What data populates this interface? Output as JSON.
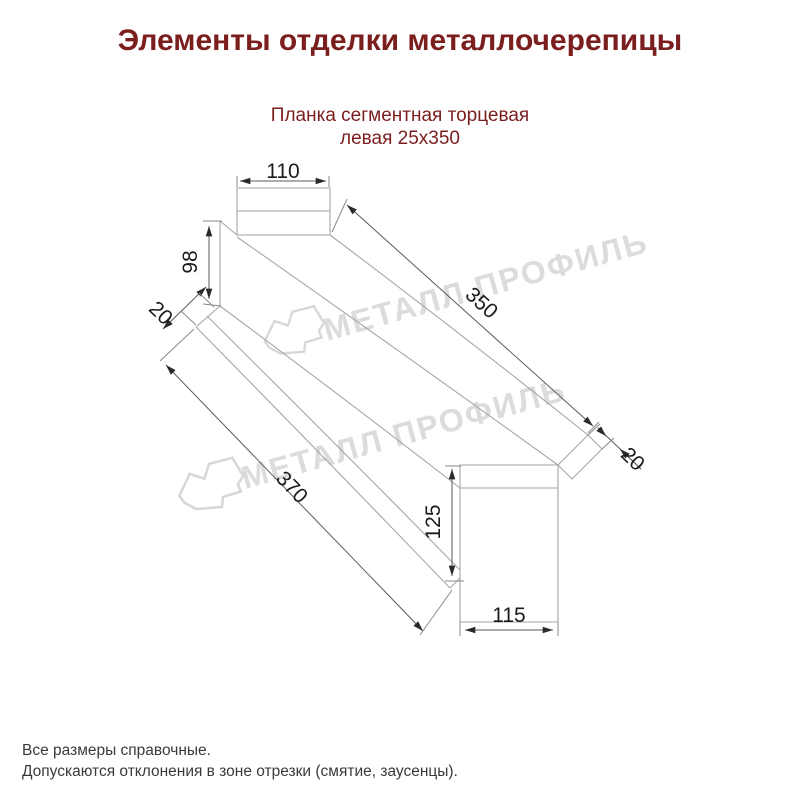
{
  "header": {
    "title": "Элементы отделки металлочерепицы",
    "subtitle_line1": "Планка сегментная торцевая",
    "subtitle_line2": "левая 25х350"
  },
  "drawing": {
    "part_name": "Планка сегментная торцевая левая 25х350",
    "dims": {
      "top_tab_width": "110",
      "left_height": "98",
      "left_hem": "20",
      "top_length": "350",
      "right_hem": "20",
      "bottom_length": "370",
      "end_height": "125",
      "end_width": "115"
    },
    "watermark_text": "МЕТАЛЛ ПРОФИЛЬ"
  },
  "footer": {
    "line1": "Все размеры справочные.",
    "line2": "Допускаются отклонения в зоне отрезки (смятие, заусенцы)."
  },
  "colors": {
    "heading": "#7a1e1e",
    "part_line": "#a6a6ab",
    "dimension_line": "#5a5a60",
    "dimension_text": "#1b1b1b",
    "watermark": "#dcdcdc",
    "footer_text": "#3a3a3a",
    "background": "#ffffff"
  }
}
